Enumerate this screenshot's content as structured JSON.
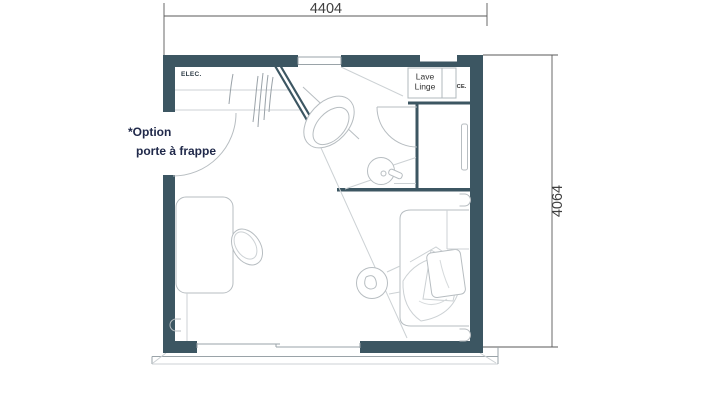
{
  "drawing": {
    "dim_width": "4404",
    "dim_height": "4064",
    "elec_label": "ELEC.",
    "lave_linge": {
      "line1": "Lave",
      "line2": "Linge"
    },
    "ce_label": "CE.",
    "option_note": {
      "line1": "*Option",
      "line2": "porte à frappe"
    }
  },
  "colors": {
    "wall": "#3c5662",
    "fixture_line": "#b7bdc1",
    "light_line": "#ccd1d4",
    "dimension_line": "#5a5a5a",
    "dimension_text": "#404040",
    "note_text": "#20294a"
  }
}
